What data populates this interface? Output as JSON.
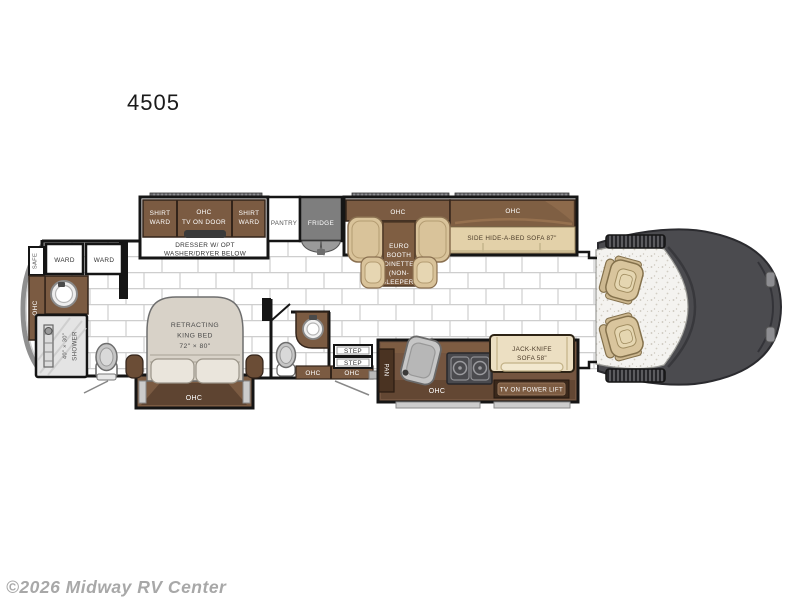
{
  "title": "4505",
  "watermark": "©2026 Midway RV Center",
  "labels": {
    "shirt_ward_1a": "SHIRT",
    "shirt_ward_1b": "WARD",
    "ohc_tv_a": "OHC",
    "ohc_tv_b": "TV ON DOOR",
    "shirt_ward_2a": "SHIRT",
    "shirt_ward_2b": "WARD",
    "dresser_a": "DRESSER W/ OPT",
    "dresser_b": "WASHER/DRYER BELOW",
    "pantry": "PANTRY",
    "fridge": "FRIDGE",
    "dinette_ohc": "OHC",
    "dinette_1": "EURO",
    "dinette_2": "BOOTH",
    "dinette_3": "DINETTE",
    "dinette_4": "(NON-",
    "dinette_5": "SLEEPER)",
    "sofa_ohc": "OHC",
    "sofa": "SIDE HIDE-A-BED SOFA 87\"",
    "safe": "SAFE",
    "ward_1": "WARD",
    "ward_2": "WARD",
    "rear_ohc": "OHC",
    "shower_a": "SHOWER",
    "shower_b": "40\" × 30\"",
    "bed_1": "RETRACTING",
    "bed_2": "KING BED",
    "bed_3": "72\" × 80\"",
    "bed_ohc": "OHC",
    "bath_ohc": "OHC",
    "entry_ohc": "OHC",
    "step_1": "STEP",
    "step_2": "STEP",
    "pan": "PAN",
    "galley_ohc": "OHC",
    "jackknife_a": "JACK-KNIFE",
    "jackknife_b": "SOFA 58\"",
    "tv_lift": "TV ON POWER LIFT"
  },
  "palette": {
    "cabinet_brown": "#7b5b42",
    "cabinet_dark": "#5e4431",
    "counter_brown": "#745540",
    "tan_upholstery": "#d9c39a",
    "cream_sofa": "#ecdfc2",
    "hidebed_tan": "#e3d1a9",
    "fridge_gray": "#7e7e7e",
    "cab_gray": "#4b4b4f",
    "bed_gray": "#d8d2c8",
    "floor_line": "#cecece",
    "wall_black": "#151515",
    "watermark_gray": "#a8a8a8"
  }
}
